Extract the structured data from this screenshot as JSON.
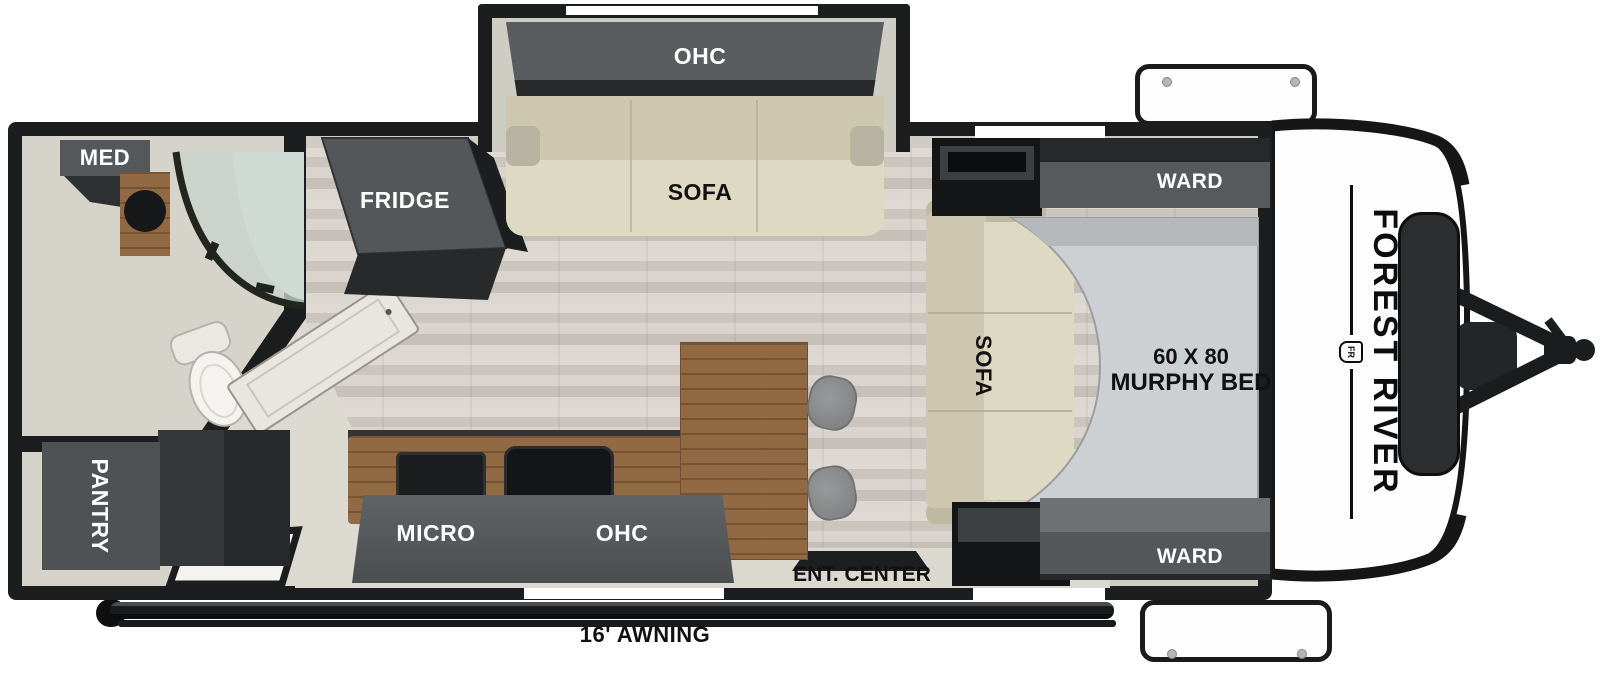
{
  "floorplan": {
    "type": "travel-trailer floor plan",
    "brand": "FOREST RIVER",
    "brand_logo": "FR",
    "labels": {
      "med": "MED",
      "fridge": "FRIDGE",
      "slideout_ohc": "OHC",
      "slideout_sofa": "SOFA",
      "bedroom_sofa": "SOFA",
      "ward_top": "WARD",
      "ward_bottom": "WARD",
      "murphy_bed_line1": "60 X 80",
      "murphy_bed_line2": "MURPHY BED",
      "pantry": "PANTRY",
      "micro": "MICRO",
      "kitchen_ohc": "OHC",
      "ent_center": "ENT. CENTER",
      "awning": "16' AWNING"
    },
    "colors": {
      "wall": "#1c1d1f",
      "cabinet_dark": "#141517",
      "cabinet_face": "#55585b",
      "sofa_tan": "#ded9c3",
      "bed_gray": "#cdd0d2",
      "wood": "#916a43",
      "floor": "#d7d3cc",
      "interior_lining": "#cfccc3",
      "label_on_dark": "#ffffff",
      "label_on_light": "#111111"
    }
  }
}
